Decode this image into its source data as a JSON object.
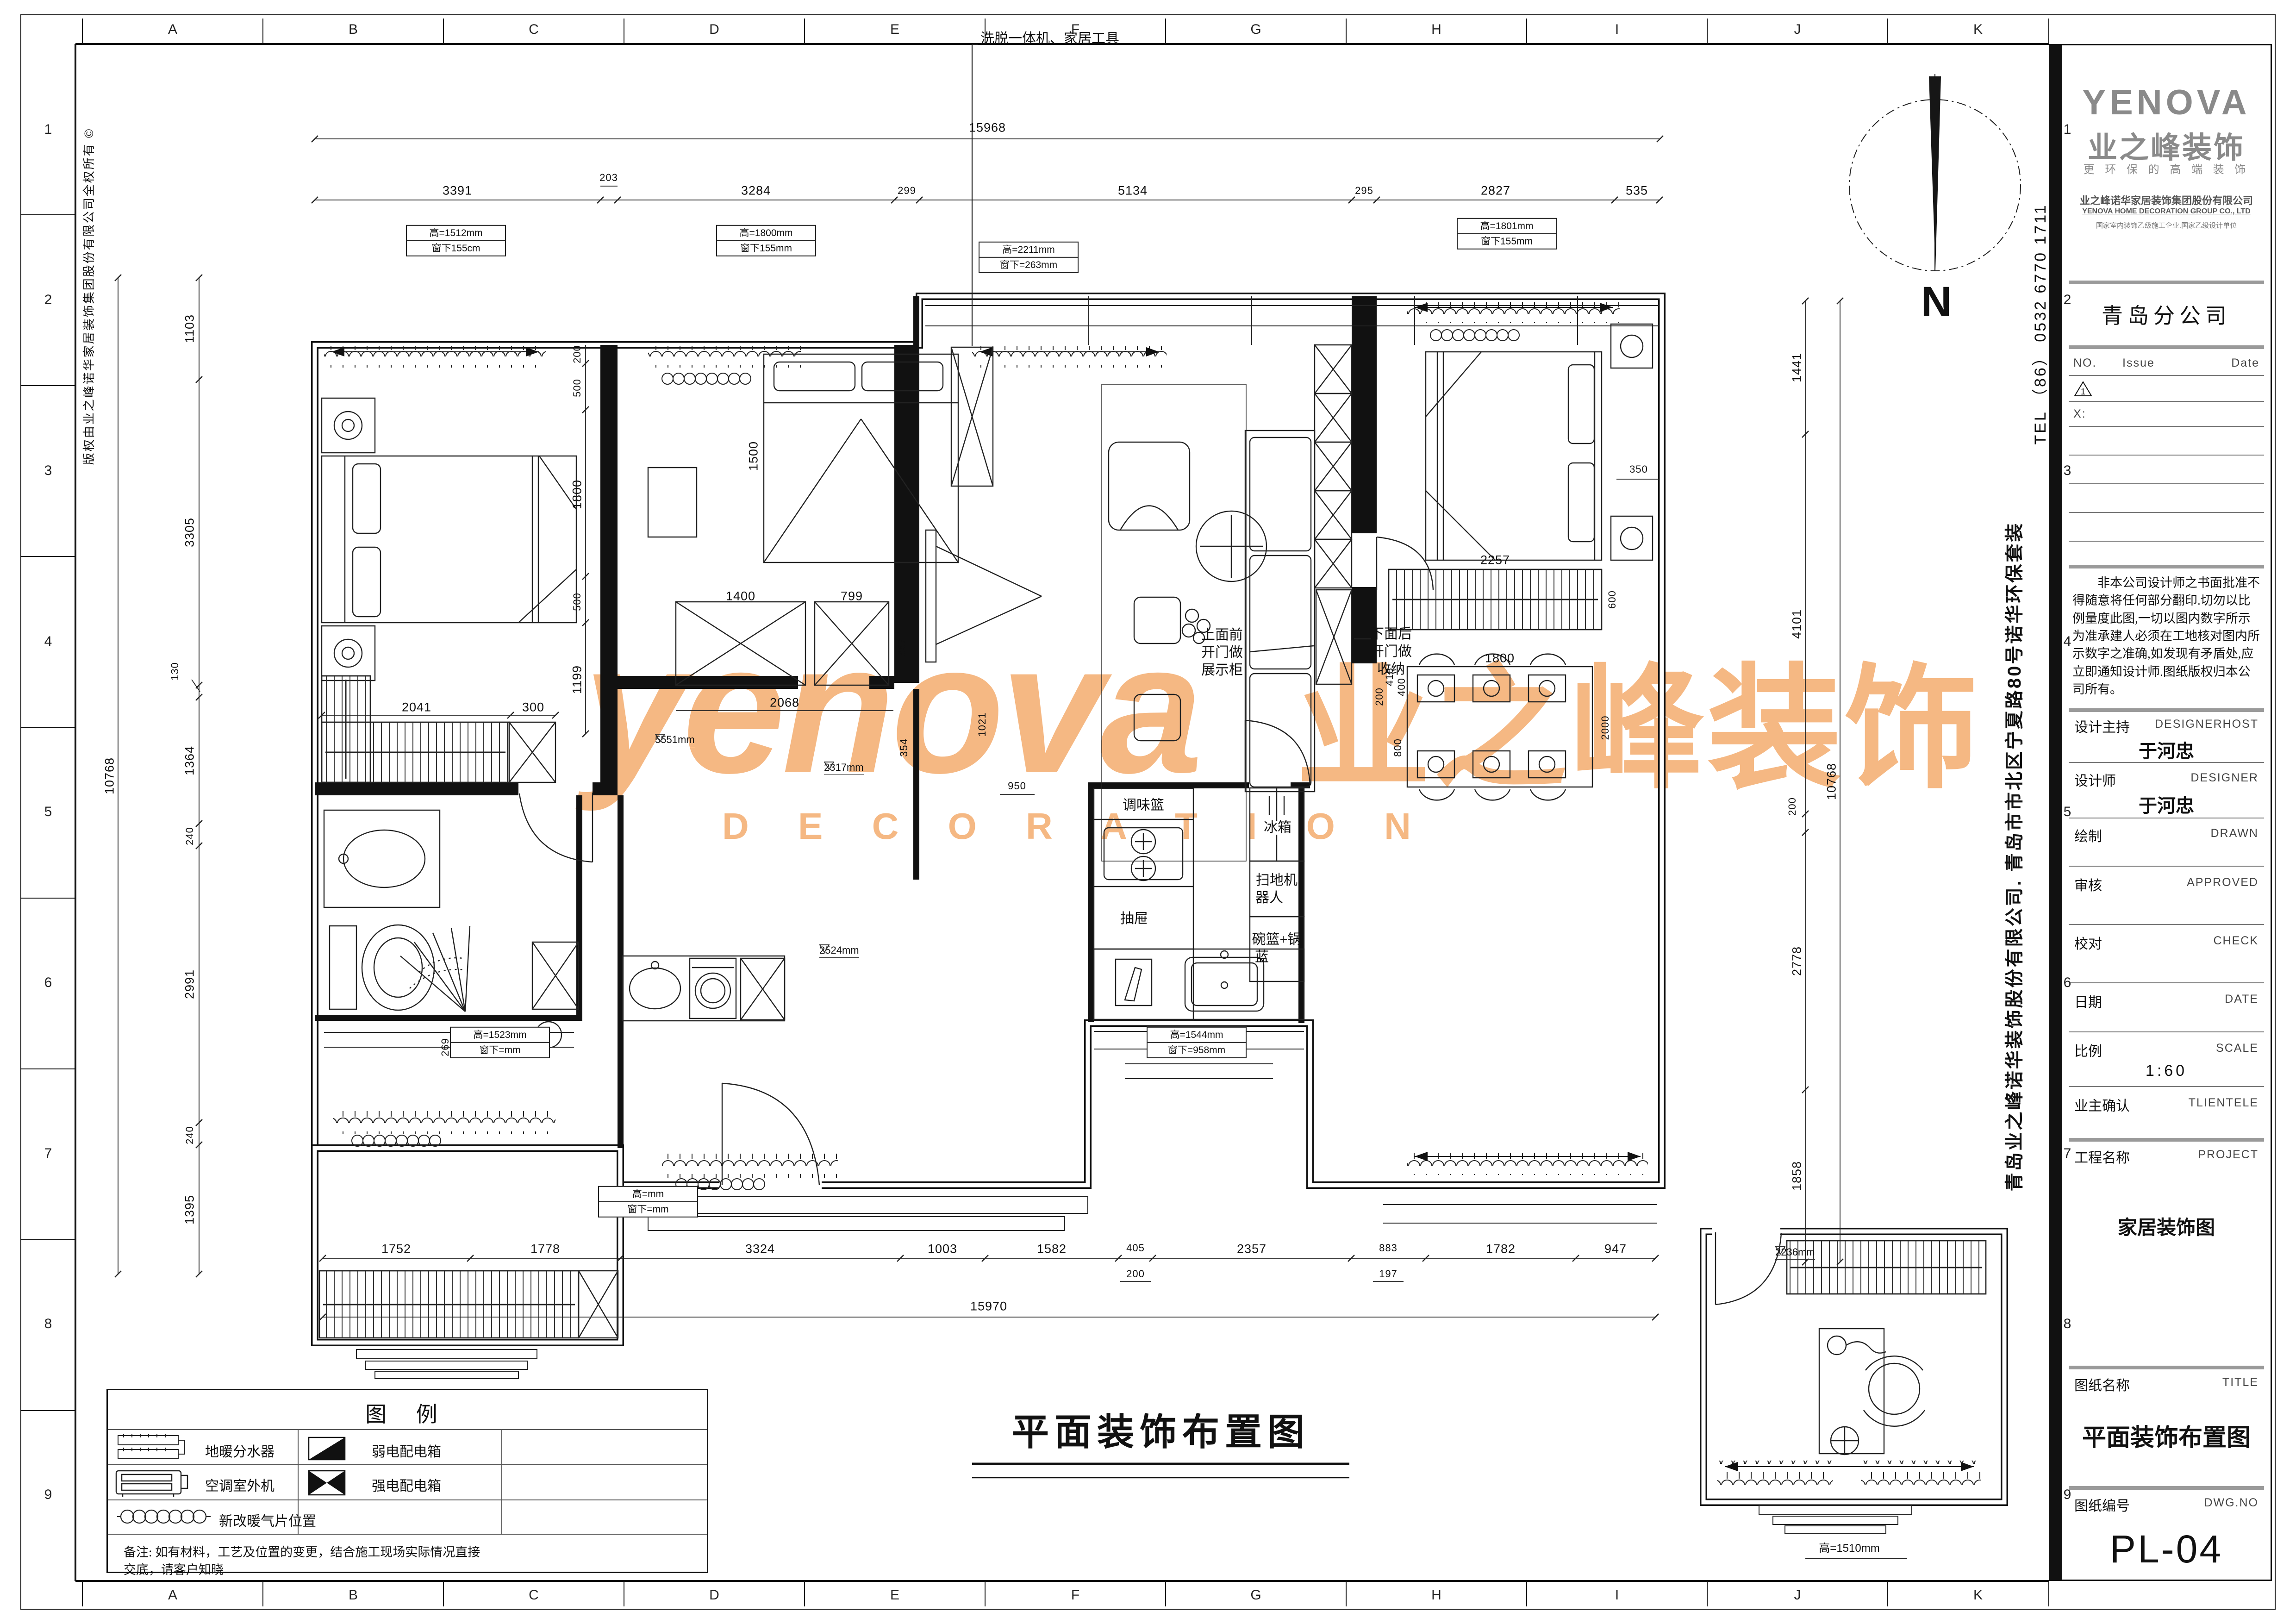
{
  "sheet": {
    "grid_letters": [
      "A",
      "B",
      "C",
      "D",
      "E",
      "F",
      "G",
      "H",
      "I",
      "J",
      "K"
    ],
    "grid_numbers": [
      "1",
      "2",
      "3",
      "4",
      "5",
      "6",
      "7",
      "8",
      "9"
    ],
    "copyright_vertical": "版权由业之峰诺华家居装饰集团股份有限公司全权所有 ©",
    "company_vertical": "青岛业之峰诺华装饰股份有限公司. 青岛市市北区宁夏路80号诺华环保套装",
    "tel_vertical": "TEL （86） 0532 6770 1711"
  },
  "watermark": {
    "en": "yenova",
    "sub": "D E C O R A T I O N",
    "cn": "业之峰装饰"
  },
  "north": {
    "label": "N"
  },
  "plan": {
    "main_title": "平面装饰布置图",
    "callout_top": "洗脱一体机、家居工具",
    "cab_upper": [
      "上面前",
      "开门做",
      "展示柜"
    ],
    "cab_lower": [
      "下面后",
      "开门做",
      "收纳"
    ],
    "kitchen": {
      "spice": "调味篮",
      "drawer": "抽屉",
      "fridge": "冰箱",
      "robot": [
        "扫地机",
        "器人"
      ],
      "bowl": [
        "碗篮+锅",
        "蓝"
      ]
    },
    "window_tags": [
      {
        "l1": "高=1512mm",
        "l2": "窗下155cm"
      },
      {
        "l1": "高=1800mm",
        "l2": "窗下155mm"
      },
      {
        "l1": "高=2211mm",
        "l2": "窗下=263mm"
      },
      {
        "l1": "高=1801mm",
        "l2": "窗下155mm"
      },
      {
        "l1": "高=1544mm",
        "l2": "窗下=958mm"
      },
      {
        "l1": "高=1523mm",
        "l2": "窗下=mm"
      },
      {
        "l1": "高=mm",
        "l2": "窗下=mm"
      }
    ],
    "study_tag": "高=1510mm",
    "level_tags": [
      "5551mm",
      "2317mm",
      "2524mm",
      "2236mm"
    ],
    "dims": {
      "top_total": "15968",
      "top": [
        "3391",
        "203",
        "3284",
        "299",
        "5134",
        "295",
        "2827",
        "535"
      ],
      "bottom": [
        "1752",
        "1778",
        "3324",
        "1003",
        "1582",
        "405",
        "2357",
        "883",
        "1782",
        "947"
      ],
      "bottom_sub": [
        "200",
        "197"
      ],
      "bottom_total": "15970",
      "left": [
        "1103",
        "3305",
        "130",
        "1364",
        "240",
        "2991",
        "240",
        "1395"
      ],
      "left_total": "10768",
      "right": [
        "1441",
        "4101",
        "200",
        "2778",
        "1858"
      ],
      "right_total": "10768",
      "master": [
        "200",
        "500",
        "1800",
        "500",
        "1199"
      ],
      "closet": [
        "2041",
        "300"
      ],
      "bed2": [
        "1500",
        "1400",
        "799",
        "2068",
        "367",
        "354"
      ],
      "right_br": [
        "2257",
        "600",
        "1800",
        "400",
        "418",
        "200",
        "800",
        "2000",
        "350"
      ],
      "hall": [
        "1021",
        "950",
        "269"
      ]
    }
  },
  "legend": {
    "title": "图   例",
    "items": [
      {
        "label": "地暖分水器"
      },
      {
        "label": "弱电配电箱"
      },
      {
        "label": "空调室外机"
      },
      {
        "label": "强电配电箱"
      },
      {
        "label": "新改暖气片位置"
      }
    ],
    "note_line1": "备注: 如有材料，工艺及位置的变更，结合施工现场实际情况直接",
    "note_line2": "交底，请客户知晓"
  },
  "title_block": {
    "logo_en": "YENOVA",
    "logo_cn": "业之峰装饰",
    "slogan": "更 环 保 的 高 端 装 饰",
    "company_cn": "业之峰诺华家居装饰集团股份有限公司",
    "company_en": "YENOVA HOME DECORATION GROUP CO., LTD",
    "qualification": "国家室内装饰乙级施工企业.国家乙级设计单位",
    "branch": "青岛分公司",
    "issue": {
      "no": "NO.",
      "issue": "Issue",
      "date": "Date",
      "row1_no": "1",
      "row2_no": "X:"
    },
    "disclaimer": "非本公司设计师之书面批准不得随意将任何部分翻印.切勿以比例量度此图,一切以图内数字所示为准承建人必须在工地核对图内所示数字之准确,如发现有矛盾处,应立即通知设计师.图纸版权归本公司所有。",
    "rows": [
      {
        "label": "设计主持",
        "en": "DESIGNERHOST",
        "value": "于河忠"
      },
      {
        "label": "设计师",
        "en": "DESIGNER",
        "value": "于河忠"
      },
      {
        "label": "绘制",
        "en": "DRAWN",
        "value": ""
      },
      {
        "label": "审核",
        "en": "APPROVED",
        "value": ""
      },
      {
        "label": "校对",
        "en": "CHECK",
        "value": ""
      },
      {
        "label": "日期",
        "en": "DATE",
        "value": ""
      },
      {
        "label": "比例",
        "en": "SCALE",
        "value": "1:60"
      },
      {
        "label": "业主确认",
        "en": "TLIENTELE",
        "value": ""
      },
      {
        "label": "工程名称",
        "en": "PROJECT",
        "value": "家居装饰图"
      },
      {
        "label": "图纸名称",
        "en": "TITLE",
        "value": "平面装饰布置图"
      },
      {
        "label": "图纸编号",
        "en": "DWG.NO",
        "value": "PL-04"
      }
    ]
  }
}
